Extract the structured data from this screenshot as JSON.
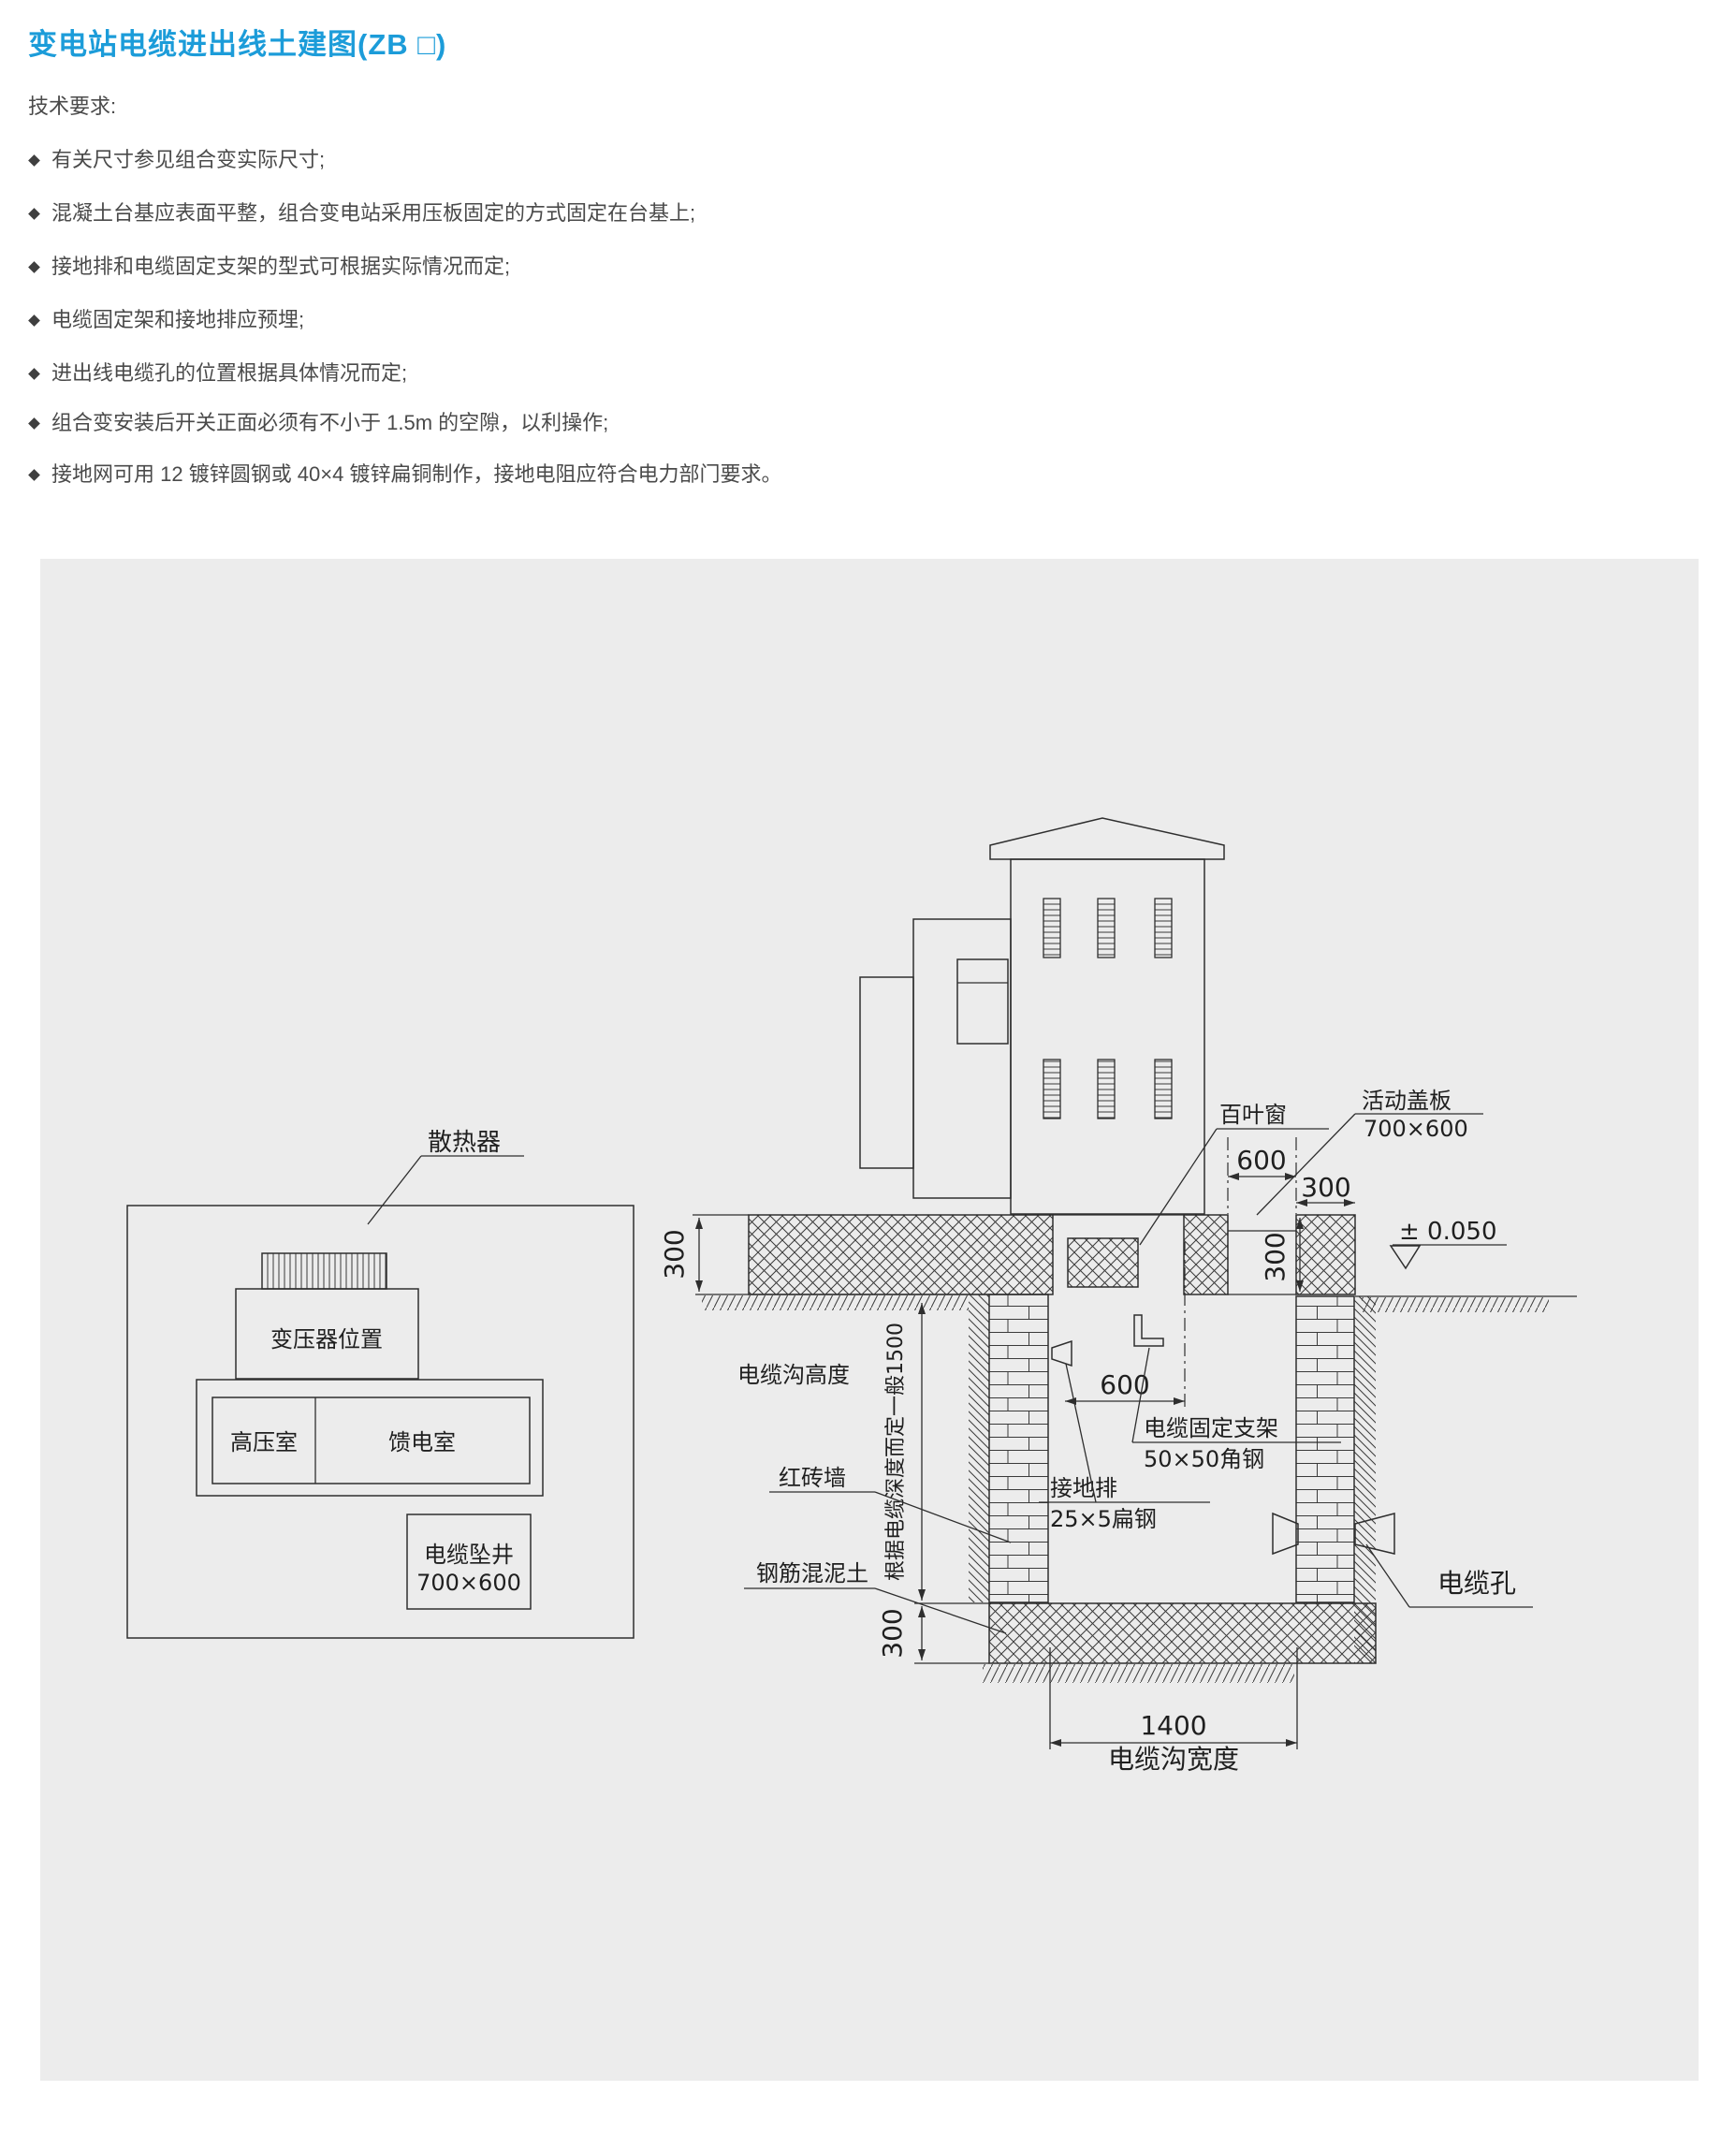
{
  "title": "变电站电缆进出线土建图(ZB □)",
  "colors": {
    "accent": "#1c9cd9",
    "panel_bg": "#ececec",
    "line_ink": "#2e2e2e",
    "body_text": "#4a4a4a"
  },
  "tech_requirements": {
    "heading": "技术要求:",
    "items": [
      "有关尺寸参见组合变实际尺寸;",
      "混凝土台基应表面平整，组合变电站采用压板固定的方式固定在台基上;",
      "接地排和电缆固定支架的型式可根据实际情况而定;",
      "电缆固定架和接地排应预埋;",
      "进出线电缆孔的位置根据具体情况而定;",
      "组合变安装后开关正面必须有不小于 1.5m 的空隙，以利操作;",
      "接地网可用 12 镀锌圆钢或 40×4 镀锌扁铜制作，接地电阻应符合电力部门要求。"
    ]
  },
  "diagram": {
    "plan": {
      "radiator": "散热器",
      "transformer": "变压器位置",
      "hv_room": "高压室",
      "feeder_room": "馈电室",
      "cable_well": "电缆坠井",
      "cable_well_size": "700×600"
    },
    "section": {
      "louver": "百叶窗",
      "cover": "活动盖板",
      "cover_size": "700×600",
      "trench_height": "电缆沟高度",
      "depth_note": "根据电缆深度而定一般1500",
      "bracket": "电缆固定支架",
      "bracket_spec": "50×50角钢",
      "ground_bar": "接地排",
      "ground_bar_spec": "25×5扁钢",
      "brick_wall": "红砖墙",
      "concrete": "钢筋混泥土",
      "cable_hole": "电缆孔",
      "trench_width": "电缆沟宽度",
      "level": "± 0.050"
    },
    "dims": {
      "d600": "600",
      "d300": "300",
      "d1400": "1400"
    }
  }
}
